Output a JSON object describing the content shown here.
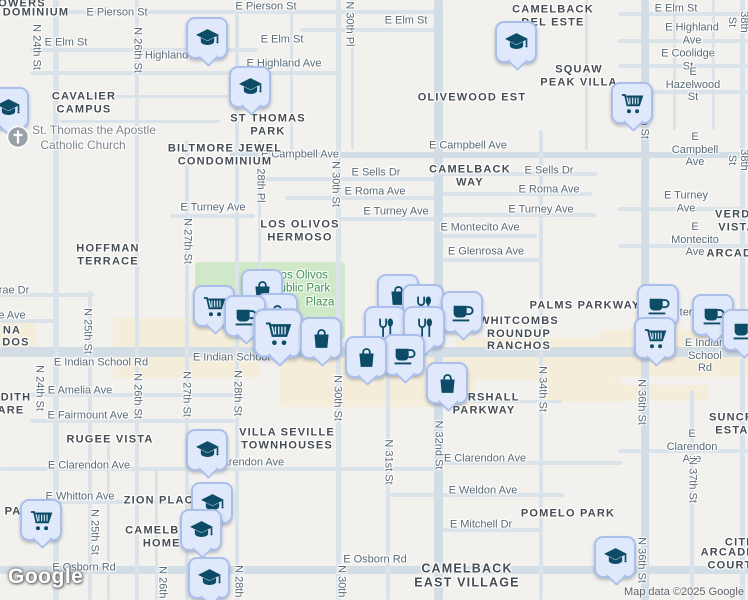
{
  "map": {
    "colors": {
      "background": "#f2f1ee",
      "road_minor": "#dbe3ea",
      "road_major": "#d2dde6",
      "park": "#cfe8c8",
      "commercial": "#f4edda",
      "marker_bg": "#dfe9fb",
      "marker_border": "#abbfec",
      "marker_icon": "#0d4c66",
      "church_gray": "#9aa2a9"
    },
    "attribution": {
      "logo": "Google",
      "text": "Map data ©2025 Google"
    },
    "areas": [
      {
        "k": "park",
        "x": 195,
        "y": 262,
        "w": 150,
        "h": 76
      },
      {
        "k": "commercial",
        "x": 0,
        "y": 323,
        "w": 36,
        "h": 30
      },
      {
        "k": "commercial",
        "x": 113,
        "y": 318,
        "w": 147,
        "h": 60
      },
      {
        "k": "commercial",
        "x": 280,
        "y": 352,
        "w": 195,
        "h": 55
      },
      {
        "k": "commercial",
        "x": 455,
        "y": 338,
        "w": 150,
        "h": 42
      },
      {
        "k": "commercial",
        "x": 600,
        "y": 330,
        "w": 148,
        "h": 47
      },
      {
        "k": "commercial",
        "x": 540,
        "y": 378,
        "w": 82,
        "h": 24
      },
      {
        "k": "commercial",
        "x": 618,
        "y": 385,
        "w": 90,
        "h": 16
      }
    ],
    "roads": [
      {
        "o": "h",
        "x": 55,
        "y": 10,
        "l": 385,
        "w": 4
      },
      {
        "o": "h",
        "x": 30,
        "y": 48,
        "l": 228,
        "w": 4
      },
      {
        "o": "h",
        "x": 300,
        "y": 28,
        "l": 137,
        "w": 4
      },
      {
        "o": "h",
        "x": 30,
        "y": 71,
        "l": 312,
        "w": 4
      },
      {
        "o": "h",
        "x": 50,
        "y": 95,
        "l": 185,
        "w": 3
      },
      {
        "o": "h",
        "x": 60,
        "y": 120,
        "l": 160,
        "w": 3
      },
      {
        "o": "h",
        "x": 618,
        "y": 12,
        "l": 130,
        "w": 4
      },
      {
        "o": "h",
        "x": 618,
        "y": 39,
        "l": 130,
        "w": 4
      },
      {
        "o": "h",
        "x": 618,
        "y": 64,
        "l": 130,
        "w": 4
      },
      {
        "o": "h",
        "x": 618,
        "y": 90,
        "l": 130,
        "w": 4
      },
      {
        "o": "h",
        "x": 230,
        "y": 152,
        "l": 518,
        "w": 6,
        "m": 1
      },
      {
        "o": "h",
        "x": 262,
        "y": 177,
        "l": 175,
        "w": 4
      },
      {
        "o": "h",
        "x": 437,
        "y": 172,
        "l": 160,
        "w": 4
      },
      {
        "o": "h",
        "x": 285,
        "y": 196,
        "l": 152,
        "w": 4
      },
      {
        "o": "h",
        "x": 437,
        "y": 192,
        "l": 155,
        "w": 4
      },
      {
        "o": "h",
        "x": 170,
        "y": 214,
        "l": 85,
        "w": 4
      },
      {
        "o": "h",
        "x": 337,
        "y": 217,
        "l": 100,
        "w": 4
      },
      {
        "o": "h",
        "x": 437,
        "y": 213,
        "l": 160,
        "w": 4
      },
      {
        "o": "h",
        "x": 618,
        "y": 207,
        "l": 130,
        "w": 4
      },
      {
        "o": "h",
        "x": 437,
        "y": 234,
        "l": 100,
        "w": 4
      },
      {
        "o": "h",
        "x": 618,
        "y": 244,
        "l": 130,
        "w": 4
      },
      {
        "o": "h",
        "x": 437,
        "y": 258,
        "l": 105,
        "w": 4
      },
      {
        "o": "h",
        "x": 0,
        "y": 293,
        "l": 95,
        "w": 4
      },
      {
        "o": "h",
        "x": 0,
        "y": 319,
        "l": 58,
        "w": 4
      },
      {
        "o": "h",
        "x": 0,
        "y": 347,
        "l": 748,
        "w": 10,
        "m": 1
      },
      {
        "o": "h",
        "x": 30,
        "y": 393,
        "l": 205,
        "w": 4
      },
      {
        "o": "h",
        "x": 30,
        "y": 419,
        "l": 205,
        "w": 4
      },
      {
        "o": "h",
        "x": 437,
        "y": 400,
        "l": 125,
        "w": 3
      },
      {
        "o": "h",
        "x": 0,
        "y": 467,
        "l": 440,
        "w": 4
      },
      {
        "o": "h",
        "x": 437,
        "y": 461,
        "l": 185,
        "w": 4
      },
      {
        "o": "h",
        "x": 618,
        "y": 449,
        "l": 130,
        "w": 4
      },
      {
        "o": "h",
        "x": 390,
        "y": 493,
        "l": 175,
        "w": 4
      },
      {
        "o": "h",
        "x": 30,
        "y": 500,
        "l": 200,
        "w": 4
      },
      {
        "o": "h",
        "x": 437,
        "y": 528,
        "l": 105,
        "w": 4
      },
      {
        "o": "h",
        "x": 0,
        "y": 566,
        "l": 748,
        "w": 8,
        "m": 1
      },
      {
        "o": "v",
        "x": 53,
        "y": 0,
        "l": 600,
        "w": 6
      },
      {
        "o": "v",
        "x": 88,
        "y": 290,
        "l": 310,
        "w": 4
      },
      {
        "o": "v",
        "x": 135,
        "y": 0,
        "l": 600,
        "w": 4
      },
      {
        "o": "v",
        "x": 107,
        "y": 440,
        "l": 160,
        "w": 3
      },
      {
        "o": "v",
        "x": 155,
        "y": 470,
        "l": 130,
        "w": 3
      },
      {
        "o": "v",
        "x": 185,
        "y": 140,
        "l": 460,
        "w": 4
      },
      {
        "o": "v",
        "x": 235,
        "y": 0,
        "l": 600,
        "w": 4
      },
      {
        "o": "v",
        "x": 258,
        "y": 140,
        "l": 215,
        "w": 3
      },
      {
        "o": "v",
        "x": 290,
        "y": 0,
        "l": 155,
        "w": 3
      },
      {
        "o": "v",
        "x": 336,
        "y": 0,
        "l": 600,
        "w": 5
      },
      {
        "o": "v",
        "x": 351,
        "y": 0,
        "l": 150,
        "w": 3
      },
      {
        "o": "v",
        "x": 386,
        "y": 350,
        "l": 250,
        "w": 4
      },
      {
        "o": "v",
        "x": 434,
        "y": 0,
        "l": 600,
        "w": 9,
        "m": 1
      },
      {
        "o": "v",
        "x": 539,
        "y": 130,
        "l": 470,
        "w": 4
      },
      {
        "o": "v",
        "x": 585,
        "y": 0,
        "l": 150,
        "w": 3
      },
      {
        "o": "v",
        "x": 641,
        "y": 0,
        "l": 600,
        "w": 8,
        "m": 1
      },
      {
        "o": "v",
        "x": 690,
        "y": 390,
        "l": 210,
        "w": 4
      },
      {
        "o": "v",
        "x": 740,
        "y": 0,
        "l": 600,
        "w": 5
      },
      {
        "o": "v",
        "x": 673,
        "y": 0,
        "l": 130,
        "w": 3
      },
      {
        "o": "v",
        "x": 712,
        "y": 0,
        "l": 130,
        "w": 3
      }
    ],
    "labels": [
      {
        "t": "E Pierson St",
        "x": 117,
        "y": 13,
        "c": "st"
      },
      {
        "t": "E Pierson St",
        "x": 266,
        "y": 7,
        "c": "st"
      },
      {
        "t": "E Elm St",
        "x": 66,
        "y": 43,
        "c": "st"
      },
      {
        "t": "E Elm St",
        "x": 282,
        "y": 40,
        "c": "st"
      },
      {
        "t": "E Elm St",
        "x": 406,
        "y": 21,
        "c": "st"
      },
      {
        "t": "E Elm St",
        "x": 676,
        "y": 9,
        "c": "st"
      },
      {
        "t": "E Highland Ave",
        "x": 172,
        "y": 56,
        "c": "st"
      },
      {
        "t": "E Highland Ave",
        "x": 284,
        "y": 64,
        "c": "st"
      },
      {
        "t": "E Highland Ave",
        "x": 692,
        "y": 34,
        "c": "st"
      },
      {
        "t": "E Coolidge St",
        "x": 688,
        "y": 60,
        "c": "st"
      },
      {
        "t": "E Hazelwood St",
        "x": 693,
        "y": 85,
        "c": "st"
      },
      {
        "t": "E Campbell Ave",
        "x": 300,
        "y": 155,
        "c": "st"
      },
      {
        "t": "E Campbell Ave",
        "x": 468,
        "y": 146,
        "c": "st"
      },
      {
        "t": "E Campbell Ave",
        "x": 695,
        "y": 150,
        "c": "st"
      },
      {
        "t": "E Sells Dr",
        "x": 376,
        "y": 173,
        "c": "st"
      },
      {
        "t": "E Sells Dr",
        "x": 549,
        "y": 171,
        "c": "st"
      },
      {
        "t": "E Roma Ave",
        "x": 375,
        "y": 192,
        "c": "st"
      },
      {
        "t": "E Roma Ave",
        "x": 549,
        "y": 190,
        "c": "st"
      },
      {
        "t": "E Turney Ave",
        "x": 213,
        "y": 208,
        "c": "st"
      },
      {
        "t": "E Turney Ave",
        "x": 396,
        "y": 212,
        "c": "st"
      },
      {
        "t": "E Turney Ave",
        "x": 541,
        "y": 210,
        "c": "st"
      },
      {
        "t": "E Turney Ave",
        "x": 686,
        "y": 202,
        "c": "st"
      },
      {
        "t": "E Montecito Ave",
        "x": 480,
        "y": 228,
        "c": "st"
      },
      {
        "t": "E Montecito Ave",
        "x": 695,
        "y": 240,
        "c": "st"
      },
      {
        "t": "E Glenrosa Ave",
        "x": 486,
        "y": 252,
        "c": "st"
      },
      {
        "t": "rae Dr",
        "x": 14,
        "y": 291,
        "c": "st"
      },
      {
        "t": "e Ave",
        "x": 12,
        "y": 316,
        "c": "st"
      },
      {
        "t": "E Indian School Rd",
        "x": 101,
        "y": 363,
        "c": "st"
      },
      {
        "t": "E Indian School Rd",
        "x": 240,
        "y": 358,
        "c": "st"
      },
      {
        "t": "E Indian School Rd",
        "x": 705,
        "y": 356,
        "c": "st"
      },
      {
        "t": "nter",
        "x": 683,
        "y": 313,
        "c": "st"
      },
      {
        "t": "E Amelia Ave",
        "x": 80,
        "y": 391,
        "c": "st"
      },
      {
        "t": "E Fairmount Ave",
        "x": 88,
        "y": 416,
        "c": "st"
      },
      {
        "t": "E Clarendon Ave",
        "x": 89,
        "y": 466,
        "c": "st"
      },
      {
        "t": "E Clarendon Ave",
        "x": 243,
        "y": 463,
        "c": "st"
      },
      {
        "t": "E Clarendon Ave",
        "x": 485,
        "y": 459,
        "c": "st"
      },
      {
        "t": "E Clarendon Ave",
        "x": 692,
        "y": 447,
        "c": "st"
      },
      {
        "t": "E Whitton Ave",
        "x": 80,
        "y": 497,
        "c": "st"
      },
      {
        "t": "E Weldon Ave",
        "x": 483,
        "y": 491,
        "c": "st"
      },
      {
        "t": "E Mitchell Dr",
        "x": 481,
        "y": 525,
        "c": "st"
      },
      {
        "t": "E Osborn Rd",
        "x": 84,
        "y": 568,
        "c": "st"
      },
      {
        "t": "E Osborn Rd",
        "x": 375,
        "y": 560,
        "c": "st"
      },
      {
        "t": "N 24th St",
        "x": 36,
        "y": 47,
        "c": "st",
        "r": 90
      },
      {
        "t": "N 24th St",
        "x": 39,
        "y": 388,
        "c": "st",
        "r": 90
      },
      {
        "t": "N 25th St",
        "x": 87,
        "y": 331,
        "c": "st",
        "r": 90
      },
      {
        "t": "N 25th St",
        "x": 94,
        "y": 532,
        "c": "st",
        "r": 90
      },
      {
        "t": "N 26th St",
        "x": 137,
        "y": 50,
        "c": "st",
        "r": 90
      },
      {
        "t": "N 26th St",
        "x": 137,
        "y": 396,
        "c": "st",
        "r": 90
      },
      {
        "t": "N 26th St",
        "x": 162,
        "y": 589,
        "c": "st",
        "r": 90
      },
      {
        "t": "N 27th St",
        "x": 187,
        "y": 241,
        "c": "st",
        "r": 90
      },
      {
        "t": "N 27th St",
        "x": 186,
        "y": 394,
        "c": "st",
        "r": 90
      },
      {
        "t": "N 28th Pl",
        "x": 260,
        "y": 180,
        "c": "st",
        "r": 90
      },
      {
        "t": "N 28th St",
        "x": 237,
        "y": 393,
        "c": "st",
        "r": 90
      },
      {
        "t": "N 28th St",
        "x": 238,
        "y": 588,
        "c": "st",
        "r": 90
      },
      {
        "t": "N 30th Pl",
        "x": 349,
        "y": 24,
        "c": "st",
        "r": 90
      },
      {
        "t": "N 30th St",
        "x": 335,
        "y": 184,
        "c": "st",
        "r": 90
      },
      {
        "t": "N 30th St",
        "x": 337,
        "y": 398,
        "c": "st",
        "r": 90
      },
      {
        "t": "N 30th St",
        "x": 341,
        "y": 588,
        "c": "st",
        "r": 90
      },
      {
        "t": "N 31st St",
        "x": 388,
        "y": 462,
        "c": "st",
        "r": 90
      },
      {
        "t": "N 32nd St",
        "x": 438,
        "y": 445,
        "c": "st",
        "r": 90
      },
      {
        "t": "N 34th St",
        "x": 542,
        "y": 389,
        "c": "st",
        "r": 90
      },
      {
        "t": "N 36th St",
        "x": 644,
        "y": 116,
        "c": "st",
        "r": 90
      },
      {
        "t": "N 36th St",
        "x": 641,
        "y": 402,
        "c": "st",
        "r": 90
      },
      {
        "t": "N 36th St",
        "x": 641,
        "y": 560,
        "c": "st",
        "r": 90
      },
      {
        "t": "N 37th St",
        "x": 692,
        "y": 480,
        "c": "st",
        "r": 90
      },
      {
        "t": "N 38th St",
        "x": 744,
        "y": 22,
        "c": "st",
        "r": 90
      },
      {
        "t": "N 38th St",
        "x": 744,
        "y": 160,
        "c": "st",
        "r": 90
      },
      {
        "t": "OWERS",
        "x": 22,
        "y": 4,
        "c": "hd"
      },
      {
        "t": "DOMINIUM",
        "x": 36,
        "y": 13,
        "c": "hd"
      },
      {
        "t": "CAVALIER\nCAMPUS",
        "x": 84,
        "y": 103,
        "c": "hd"
      },
      {
        "t": "ST THOMAS\nPARK",
        "x": 268,
        "y": 125,
        "c": "hd"
      },
      {
        "t": "CAMELBACK\nDEL ESTE",
        "x": 553,
        "y": 16,
        "c": "hd"
      },
      {
        "t": "SQUAW\nPEAK VILLA",
        "x": 579,
        "y": 76,
        "c": "hd"
      },
      {
        "t": "OLIVEWOOD EST",
        "x": 472,
        "y": 98,
        "c": "hd"
      },
      {
        "t": "BILTMORE JEWEL\nCONDOMINIUM",
        "x": 225,
        "y": 155,
        "c": "hd"
      },
      {
        "t": "HOFFMAN\nTERRACE",
        "x": 108,
        "y": 255,
        "c": "hd"
      },
      {
        "t": "LOS OLIVOS\nHERMOSO",
        "x": 300,
        "y": 231,
        "c": "hd"
      },
      {
        "t": "CAMELBACK\nWAY",
        "x": 470,
        "y": 176,
        "c": "hd"
      },
      {
        "t": "VERDE VISTA",
        "x": 737,
        "y": 221,
        "c": "hd"
      },
      {
        "t": "ARCADIA",
        "x": 736,
        "y": 254,
        "c": "hd"
      },
      {
        "t": "NA",
        "x": 12,
        "y": 331,
        "c": "hd"
      },
      {
        "t": "DOS",
        "x": 16,
        "y": 343,
        "c": "hd"
      },
      {
        "t": "PALMS PARKWAY",
        "x": 585,
        "y": 306,
        "c": "hd"
      },
      {
        "t": "WHITCOMBS\nROUNDUP\nRANCHOS",
        "x": 519,
        "y": 334,
        "c": "hd"
      },
      {
        "t": "MARSHALL\nPARKWAY",
        "x": 484,
        "y": 404,
        "c": "hd"
      },
      {
        "t": "DITH",
        "x": 16,
        "y": 398,
        "c": "hd"
      },
      {
        "t": "ARE",
        "x": 11,
        "y": 411,
        "c": "hd"
      },
      {
        "t": "RUGEE VISTA",
        "x": 110,
        "y": 440,
        "c": "hd"
      },
      {
        "t": "VILLA SEVILLE\nTOWNHOUSES",
        "x": 287,
        "y": 439,
        "c": "hd"
      },
      {
        "t": "SUNCREST\nESTATES",
        "x": 744,
        "y": 424,
        "c": "hd"
      },
      {
        "t": "ZION PLACE",
        "x": 163,
        "y": 501,
        "c": "hd"
      },
      {
        "t": "CAMELBACK\nHOMES",
        "x": 166,
        "y": 537,
        "c": "hd"
      },
      {
        "t": "PA",
        "x": 13,
        "y": 512,
        "c": "hd"
      },
      {
        "t": "POMELO PARK",
        "x": 568,
        "y": 514,
        "c": "hd"
      },
      {
        "t": "CITRUS",
        "x": 749,
        "y": 543,
        "c": "hd"
      },
      {
        "t": "ARCADIA COURT",
        "x": 730,
        "y": 559,
        "c": "hd"
      },
      {
        "t": "CAMELBACK\nEAST VILLAGE",
        "x": 467,
        "y": 576,
        "c": "hd",
        "fs": 12.5
      },
      {
        "t": "Los Olivos",
        "x": 301,
        "y": 276,
        "c": "pk"
      },
      {
        "t": "Public Park",
        "x": 301,
        "y": 289,
        "c": "pk"
      },
      {
        "t": "Plaza",
        "x": 320,
        "y": 303,
        "c": "pk"
      },
      {
        "t": "St. Thomas the Apostle",
        "x": 94,
        "y": 131,
        "c": "poi"
      },
      {
        "t": "Catholic Church",
        "x": 83,
        "y": 146,
        "c": "poi"
      }
    ],
    "markers": [
      {
        "t": "school",
        "x": 207,
        "y": 38
      },
      {
        "t": "school",
        "x": 516,
        "y": 42
      },
      {
        "t": "school",
        "x": 250,
        "y": 87
      },
      {
        "t": "school",
        "x": 8,
        "y": 108
      },
      {
        "t": "grocery",
        "x": 632,
        "y": 103
      },
      {
        "t": "church",
        "x": 18,
        "y": 137
      },
      {
        "t": "shopping",
        "x": 262,
        "y": 290
      },
      {
        "t": "shopping",
        "x": 398,
        "y": 295
      },
      {
        "t": "restaurant",
        "x": 423,
        "y": 305
      },
      {
        "t": "cafe",
        "x": 658,
        "y": 305
      },
      {
        "t": "grocery",
        "x": 214,
        "y": 306
      },
      {
        "t": "cafe",
        "x": 462,
        "y": 312
      },
      {
        "t": "shopping",
        "x": 277,
        "y": 314
      },
      {
        "t": "cafe",
        "x": 713,
        "y": 315
      },
      {
        "t": "cafe",
        "x": 245,
        "y": 316
      },
      {
        "t": "restaurant",
        "x": 385,
        "y": 327
      },
      {
        "t": "restaurant",
        "x": 424,
        "y": 327
      },
      {
        "t": "cafe",
        "x": 743,
        "y": 330
      },
      {
        "t": "grocery",
        "x": 278,
        "y": 333,
        "s": 1.18
      },
      {
        "t": "grocery",
        "x": 655,
        "y": 338
      },
      {
        "t": "shopping",
        "x": 321,
        "y": 338
      },
      {
        "t": "cafe",
        "x": 404,
        "y": 355
      },
      {
        "t": "shopping",
        "x": 366,
        "y": 357
      },
      {
        "t": "shopping",
        "x": 447,
        "y": 383
      },
      {
        "t": "school",
        "x": 207,
        "y": 450
      },
      {
        "t": "school",
        "x": 212,
        "y": 503
      },
      {
        "t": "grocery",
        "x": 41,
        "y": 520
      },
      {
        "t": "school",
        "x": 201,
        "y": 530
      },
      {
        "t": "school",
        "x": 615,
        "y": 557
      },
      {
        "t": "school",
        "x": 209,
        "y": 578
      }
    ]
  }
}
